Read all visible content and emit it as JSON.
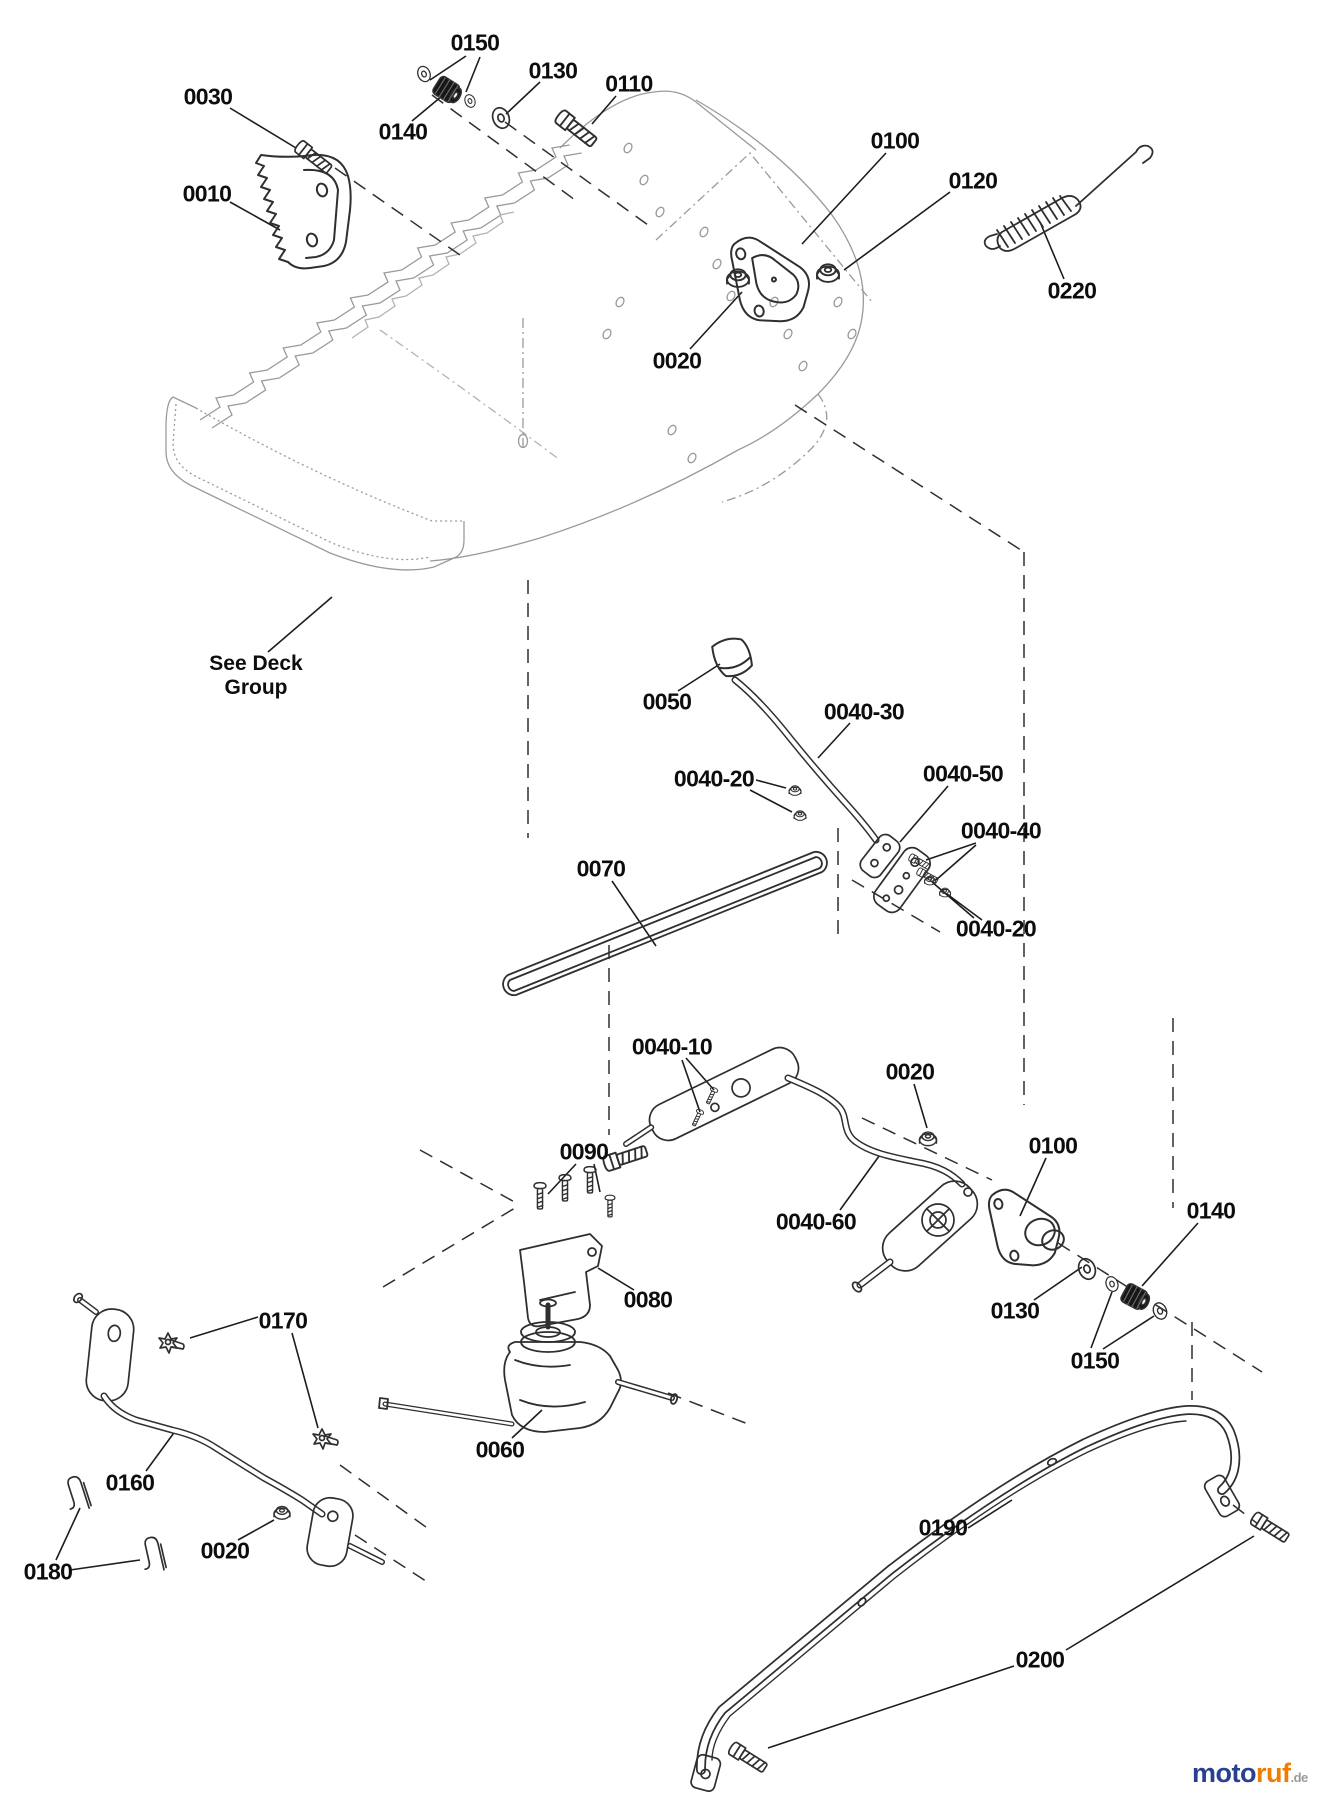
{
  "diagram": {
    "type": "exploded-parts-diagram",
    "subject": "walk-behind mower deck / drive assembly",
    "note": {
      "line1": "See Deck",
      "line2": "Group"
    },
    "labels": [
      {
        "text": "0030",
        "x": 208,
        "y": 97
      },
      {
        "text": "0150",
        "x": 475,
        "y": 43
      },
      {
        "text": "0130",
        "x": 553,
        "y": 71
      },
      {
        "text": "0110",
        "x": 629,
        "y": 84
      },
      {
        "text": "0140",
        "x": 403,
        "y": 132
      },
      {
        "text": "0010",
        "x": 207,
        "y": 194
      },
      {
        "text": "0100",
        "x": 895,
        "y": 141
      },
      {
        "text": "0120",
        "x": 973,
        "y": 181
      },
      {
        "text": "0220",
        "x": 1072,
        "y": 291
      },
      {
        "text": "0020",
        "x": 677,
        "y": 361
      },
      {
        "text": "0050",
        "x": 667,
        "y": 702
      },
      {
        "text": "0040-30",
        "x": 864,
        "y": 712
      },
      {
        "text": "0040-20",
        "x": 714,
        "y": 779
      },
      {
        "text": "0040-50",
        "x": 963,
        "y": 774
      },
      {
        "text": "0040-40",
        "x": 1001,
        "y": 831
      },
      {
        "text": "0070",
        "x": 601,
        "y": 869
      },
      {
        "text": "0040-20",
        "x": 996,
        "y": 929
      },
      {
        "text": "0040-10",
        "x": 672,
        "y": 1047
      },
      {
        "text": "0020",
        "x": 910,
        "y": 1072
      },
      {
        "text": "0090",
        "x": 584,
        "y": 1152
      },
      {
        "text": "0100",
        "x": 1053,
        "y": 1146
      },
      {
        "text": "0140",
        "x": 1211,
        "y": 1211
      },
      {
        "text": "0040-60",
        "x": 816,
        "y": 1222
      },
      {
        "text": "0080",
        "x": 648,
        "y": 1300
      },
      {
        "text": "0130",
        "x": 1015,
        "y": 1311
      },
      {
        "text": "0150",
        "x": 1095,
        "y": 1361
      },
      {
        "text": "0170",
        "x": 283,
        "y": 1321
      },
      {
        "text": "0060",
        "x": 500,
        "y": 1450
      },
      {
        "text": "0160",
        "x": 130,
        "y": 1483
      },
      {
        "text": "0020",
        "x": 225,
        "y": 1551
      },
      {
        "text": "0180",
        "x": 48,
        "y": 1572
      },
      {
        "text": "0190",
        "x": 943,
        "y": 1528
      },
      {
        "text": "0200",
        "x": 1040,
        "y": 1660
      }
    ],
    "watermark": {
      "moto": "moto",
      "ruf": "ruf",
      "domain": ".de"
    },
    "colors": {
      "part_line": "#2f2f2f",
      "deck_line": "#9a9a9a",
      "label_text": "#0d0d0d",
      "moto_blue": "#27418f",
      "ruf_orange": "#ee7d00",
      "domain_gray": "#9a9a9a"
    }
  }
}
